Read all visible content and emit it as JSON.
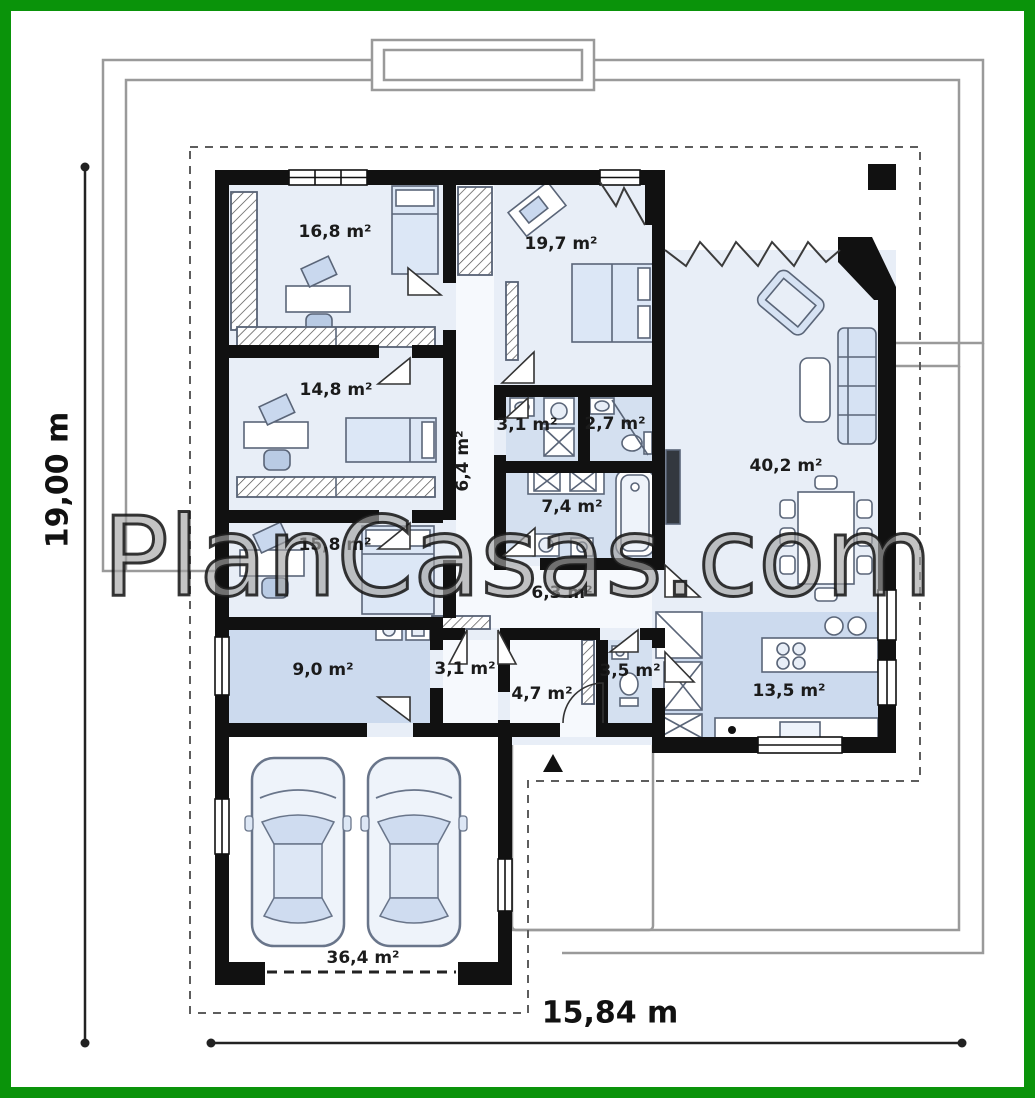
{
  "watermark": "PlanCasas.com",
  "dimensions": {
    "height": "19,00 m",
    "width": "15,84 m"
  },
  "rooms": [
    {
      "area": "16,8 m²"
    },
    {
      "area": "19,7 m²"
    },
    {
      "area": "14,8 m²"
    },
    {
      "area": "3,1 m²"
    },
    {
      "area": "2,7 m²"
    },
    {
      "area": "6,4 m²"
    },
    {
      "area": "7,4 m²"
    },
    {
      "area": "40,2 m²"
    },
    {
      "area": "15,8 m²"
    },
    {
      "area": "6,3 m²"
    },
    {
      "area": "9,0 m²"
    },
    {
      "area": "3,1 m²"
    },
    {
      "area": "4,7 m²"
    },
    {
      "area": "3,5 m²"
    },
    {
      "area": "13,5 m²"
    },
    {
      "area": "36,4 m²"
    }
  ],
  "colors": {
    "frame_green": "#0a930a",
    "wall_black": "#111111",
    "floor_light": "#e8eef7",
    "floor_medium": "#ccdaee",
    "furniture_blue": "#d9e4f3",
    "outline_gray": "#9a9a9a"
  }
}
